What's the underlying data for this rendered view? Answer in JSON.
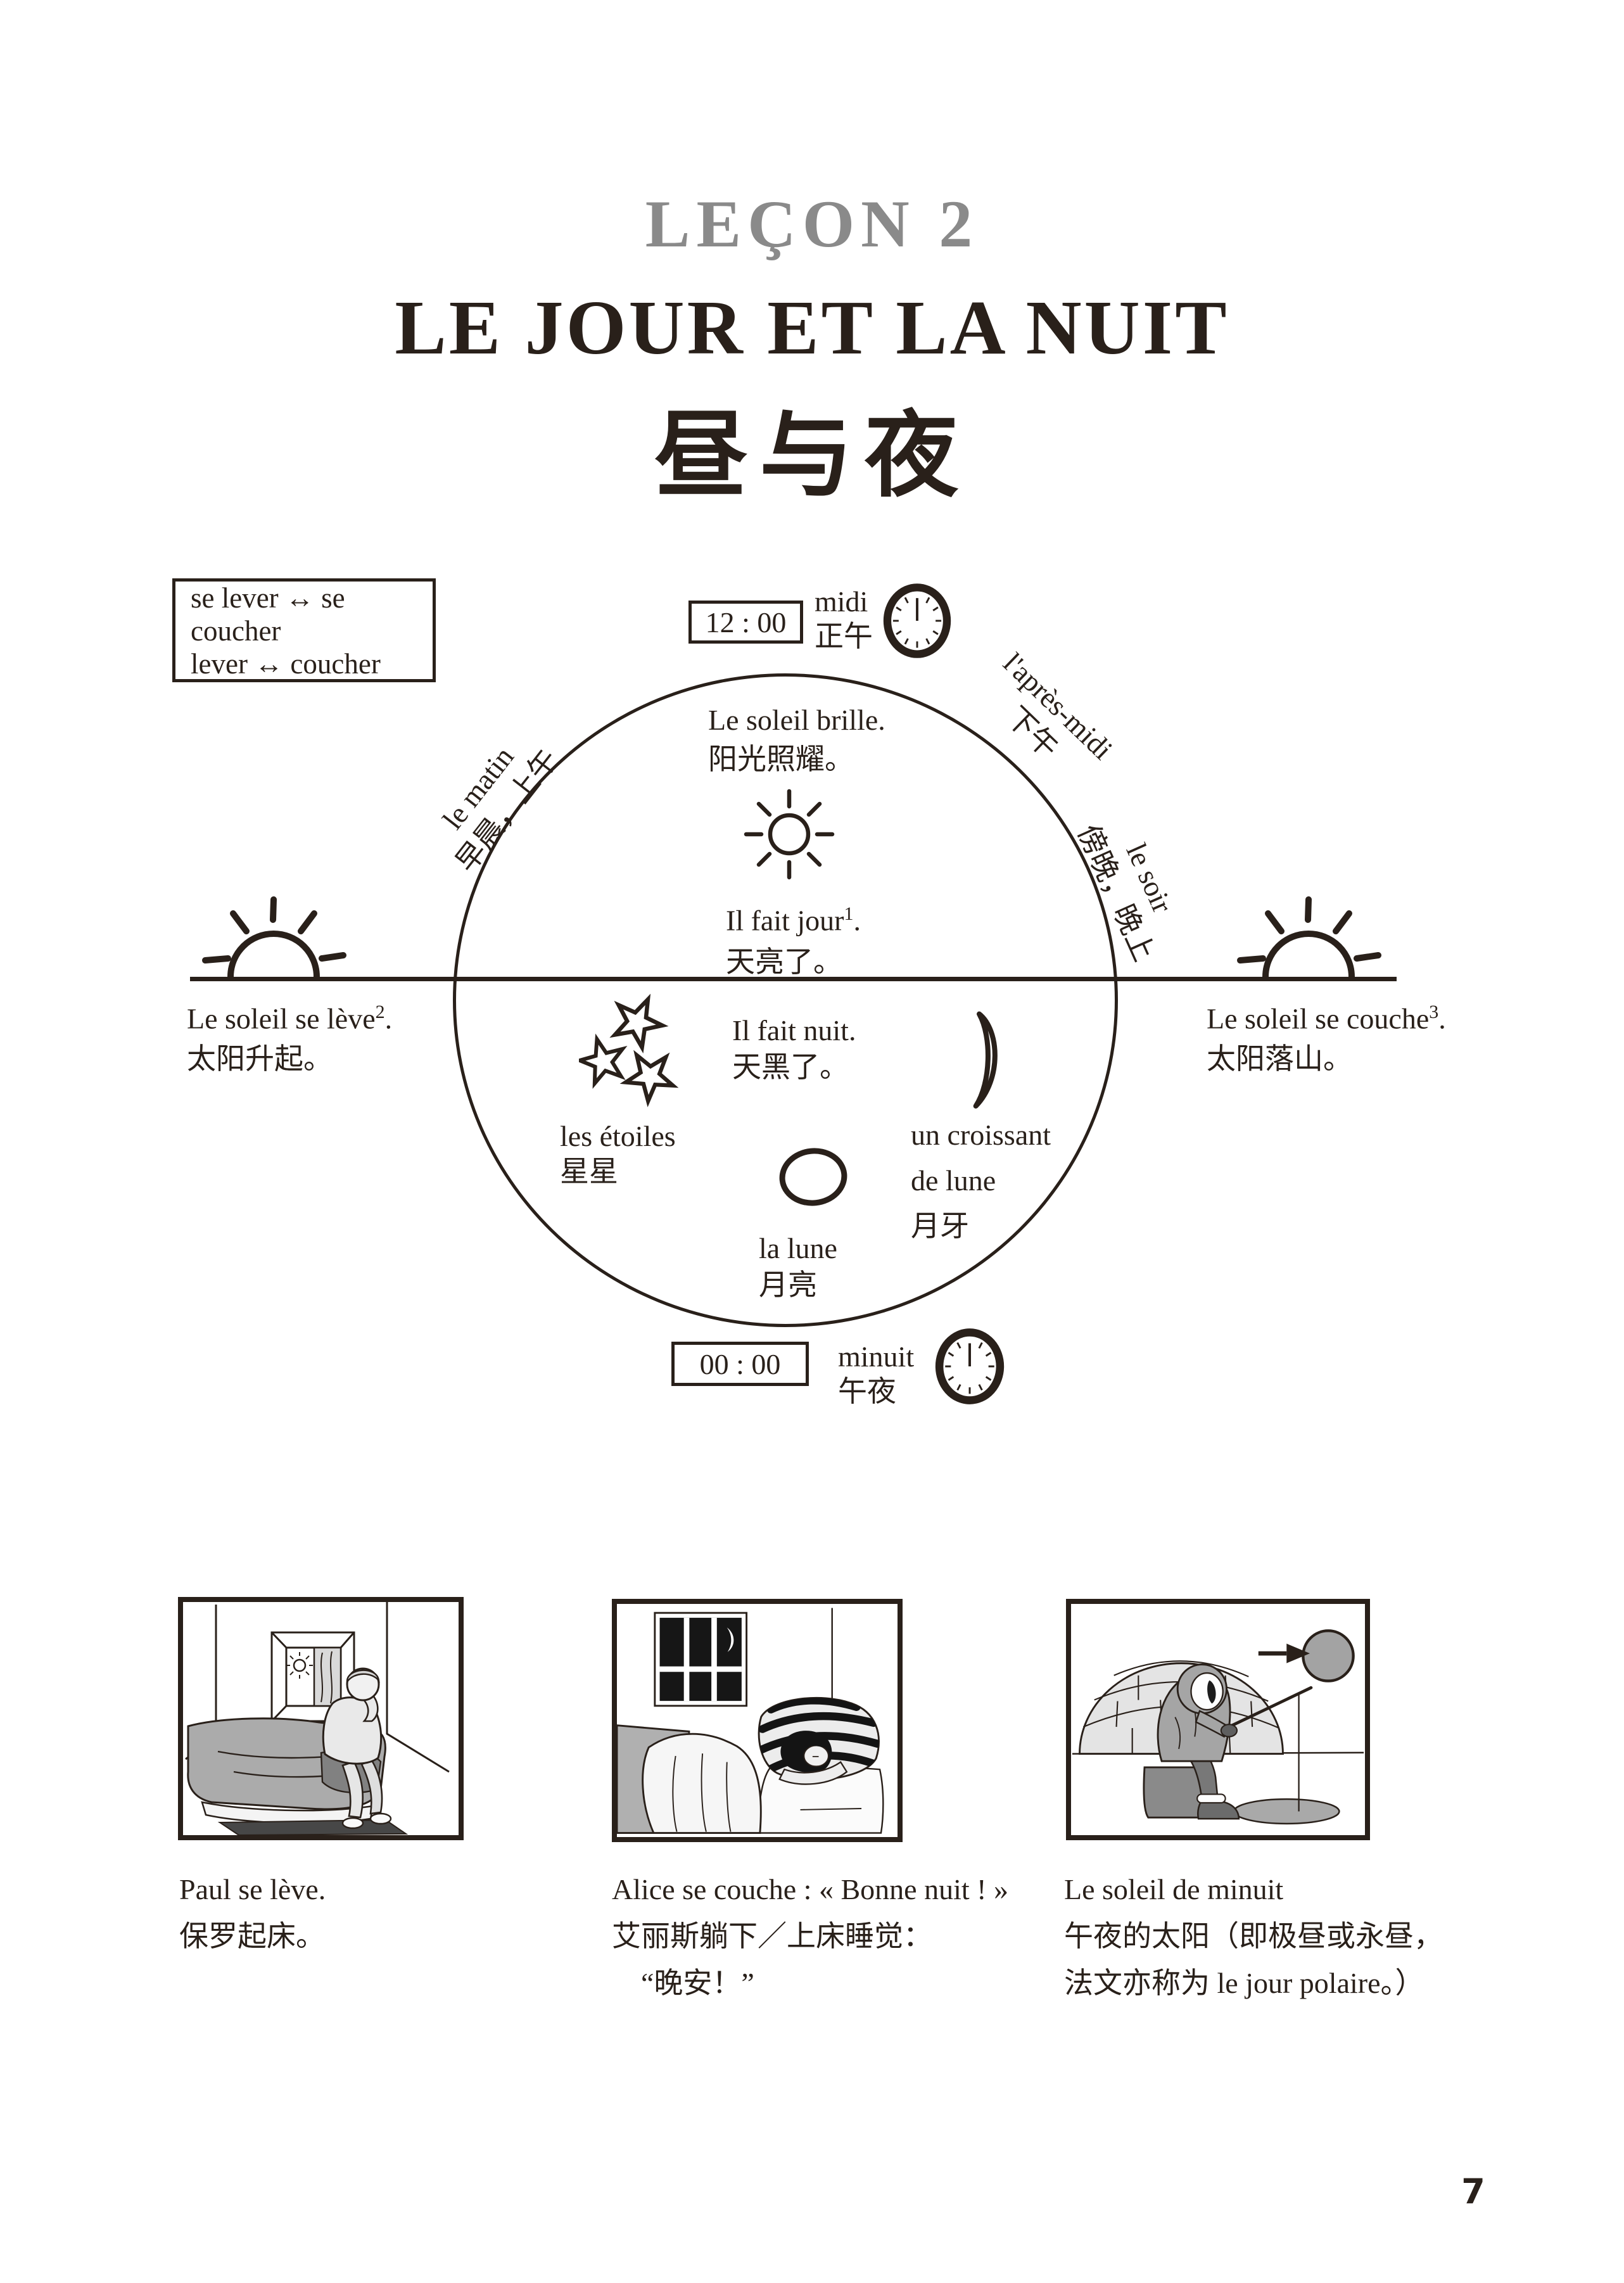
{
  "colors": {
    "ink": "#29201a",
    "title_gray": "#8a8a8a"
  },
  "header": {
    "lesson": "LEÇON 2",
    "title_fr": "LE JOUR ET LA NUIT",
    "title_zh": "昼与夜"
  },
  "vocab": {
    "line1": "se lever ↔ se coucher",
    "line2": "lever ↔ coucher"
  },
  "diagram": {
    "noon": {
      "time": "12 : 00",
      "fr": "midi",
      "zh": "正午"
    },
    "midnight": {
      "time": "00 : 00",
      "fr": "minuit",
      "zh": "午夜"
    },
    "morning": {
      "fr": "le matin",
      "zh": "早晨，上午"
    },
    "afternoon": {
      "fr": "l'après-midi",
      "zh": "下午"
    },
    "evening": {
      "fr": "le soir",
      "zh": "傍晚，晚上"
    },
    "sun_shines": {
      "fr": "Le soleil brille.",
      "zh": "阳光照耀。"
    },
    "daylight": {
      "fr": "Il fait jour",
      "sup": "1",
      "dot": ".",
      "zh": "天亮了。"
    },
    "night_fall": {
      "fr": "Il fait nuit.",
      "zh": "天黑了。"
    },
    "sunrise": {
      "fr": "Le soleil se lève",
      "sup": "2",
      "dot": ".",
      "zh": "太阳升起。"
    },
    "sunset": {
      "fr": "Le soleil se couche",
      "sup": "3",
      "dot": ".",
      "zh": "太阳落山。"
    },
    "stars": {
      "fr": "les étoiles",
      "zh": "星星"
    },
    "crescent": {
      "fr1": "un croissant",
      "fr2": "de lune",
      "zh": "月牙"
    },
    "moon": {
      "fr": "la lune",
      "zh": "月亮"
    }
  },
  "panels": [
    {
      "fr": "Paul se lève.",
      "zh1": "保罗起床。",
      "zh2": ""
    },
    {
      "fr": "Alice se couche : « Bonne nuit ! »",
      "zh1": "艾丽斯躺下／上床睡觉：",
      "zh2": "“晚安！”"
    },
    {
      "fr": "Le soleil de minuit",
      "zh1": "午夜的太阳（即极昼或永昼，",
      "zh2": "法文亦称为 le jour polaire。）"
    }
  ],
  "page_number": "7"
}
